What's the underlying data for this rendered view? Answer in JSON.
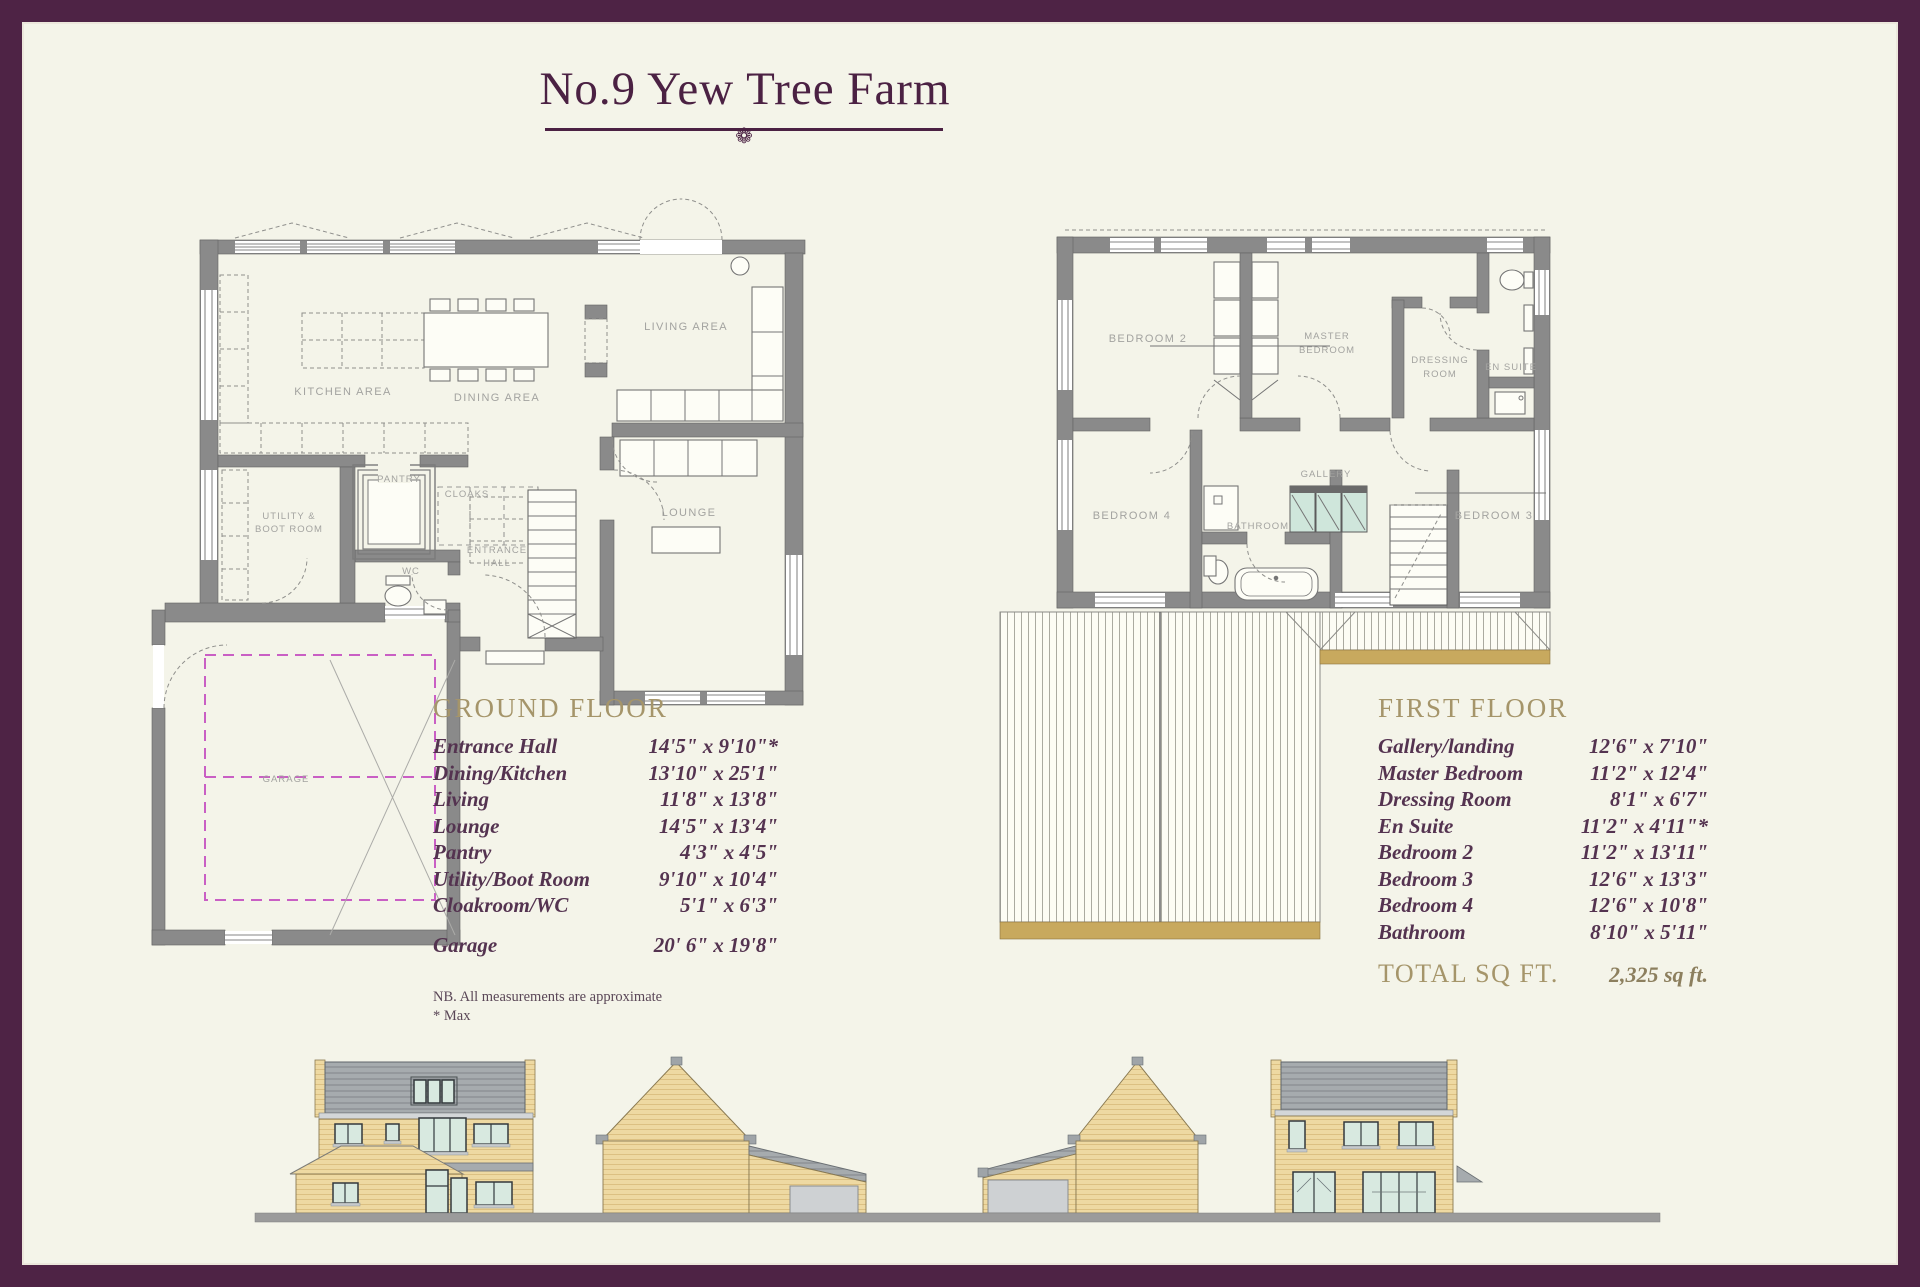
{
  "page": {
    "title_text": "No.9 Yew Tree Farm",
    "ornament": "❁"
  },
  "ground_floor": {
    "heading": "GROUND FLOOR",
    "rooms": [
      {
        "label": "Entrance Hall",
        "size": "14'5\" x 9'10\"*"
      },
      {
        "label": "Dining/Kitchen",
        "size": "13'10\" x 25'1\""
      },
      {
        "label": "Living",
        "size": "11'8\" x 13'8\""
      },
      {
        "label": "Lounge",
        "size": "14'5\" x 13'4\""
      },
      {
        "label": "Pantry",
        "size": "4'3\" x 4'5\""
      },
      {
        "label": "Utility/Boot Room",
        "size": "9'10\" x 10'4\""
      },
      {
        "label": "Cloakroom/WC",
        "size": "5'1\" x 6'3\""
      }
    ],
    "garage": {
      "label": "Garage",
      "size": "20' 6\" x 19'8\""
    },
    "note_line1": "NB. All measurements are approximate",
    "note_line2": "* Max"
  },
  "first_floor": {
    "heading": "FIRST FLOOR",
    "rooms": [
      {
        "label": "Gallery/landing",
        "size": "12'6\" x 7'10\""
      },
      {
        "label": "Master Bedroom",
        "size": "11'2\" x 12'4\""
      },
      {
        "label": "Dressing Room",
        "size": "8'1\" x 6'7\""
      },
      {
        "label": "En Suite",
        "size": "11'2\" x 4'11\"*"
      },
      {
        "label": "Bedroom 2",
        "size": "11'2\" x 13'11\""
      },
      {
        "label": "Bedroom 3",
        "size": "12'6\" x 13'3\""
      },
      {
        "label": "Bedroom 4",
        "size": "12'6\" x 10'8\""
      },
      {
        "label": "Bathroom",
        "size": "8'10\" x 5'11\""
      }
    ],
    "total_label": "TOTAL SQ FT.",
    "total_value": "2,325 sq ft."
  },
  "ground_plan": {
    "kitchen": "KITCHEN AREA",
    "dining": "DINING AREA",
    "living": "LIVING AREA",
    "pantry": "PANTRY",
    "cloaks": "CLOAKS",
    "lounge": "LOUNGE",
    "entrance_l1": "ENTRANCE",
    "entrance_l2": "HALL",
    "wc": "WC",
    "utility_l1": "UTILITY &",
    "utility_l2": "BOOT ROOM",
    "garage": "GARAGE"
  },
  "first_plan": {
    "bedroom2": "BEDROOM 2",
    "master_l1": "MASTER",
    "master_l2": "BEDROOM",
    "dressing_l1": "DRESSING",
    "dressing_l2": "ROOM",
    "ensuite": "EN SUITE",
    "bedroom4": "BEDROOM 4",
    "bathroom": "BATHROOM",
    "gallery": "GALLERY",
    "bedroom3": "BEDROOM 3"
  },
  "colors": {
    "border_plum": "#4e2345",
    "title_plum": "#4b2143",
    "heading_gold": "#a5956a",
    "list_text": "#543350",
    "plan_wall_gray": "#8a8a8a",
    "plan_label_gray": "#a3a3a0",
    "garage_dash_pink": "#c95fc4",
    "cupboard_teal": "#cfe6db",
    "roof_fascia_tan": "#c8a95e",
    "elevation_wall_tan": "#eed9a2",
    "elevation_roof_gray": "#a6abae",
    "window_glass_green": "#d8e9e0",
    "ground_bar_gray": "#9b9b9b"
  }
}
